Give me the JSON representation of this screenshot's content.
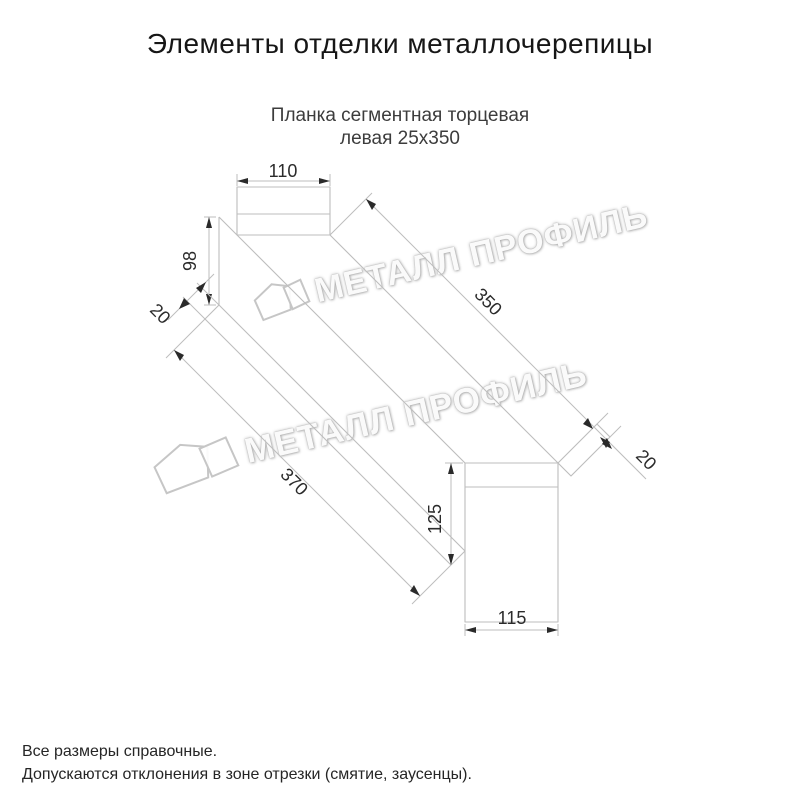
{
  "header": {
    "title": "Элементы отделки металлочерепицы"
  },
  "subtitle": {
    "line1": "Планка сегментная торцевая",
    "line2": "левая 25х350"
  },
  "dimensions": {
    "top_tab_width": "110",
    "side_height": "98",
    "bottom_hem": "20",
    "length_top": "350",
    "length_bottom": "370",
    "end_hem": "20",
    "end_tab_height": "125",
    "end_tab_width": "115"
  },
  "watermark": {
    "text": "МЕТАЛЛ ПРОФИЛЬ"
  },
  "footer": {
    "line1": "Все размеры справочные.",
    "line2": "Допускаются отклонения в зоне отрезки (смятие, заусенцы)."
  },
  "colors": {
    "outline": "#bdbdbd",
    "dimension_text": "#2b2b2b",
    "title_text": "#161616"
  }
}
